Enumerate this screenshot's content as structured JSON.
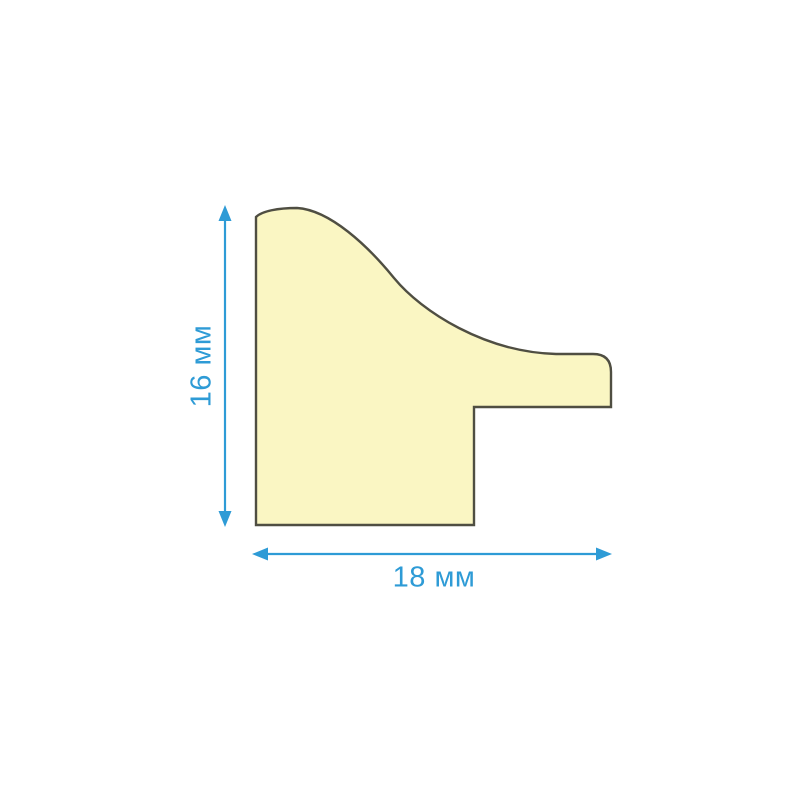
{
  "diagram": {
    "labels": {
      "height": "16 мм",
      "width": "18 мм"
    },
    "colors": {
      "dimension_accent": "#2E9BD6",
      "profile_fill": "#FAF6C3",
      "profile_outline": "#4F4E42",
      "background": "#FFFFFF"
    },
    "icons": {
      "vertical_arrow": "double-headed-arrow-vertical-icon",
      "horizontal_arrow": "double-headed-arrow-horizontal-icon"
    }
  }
}
